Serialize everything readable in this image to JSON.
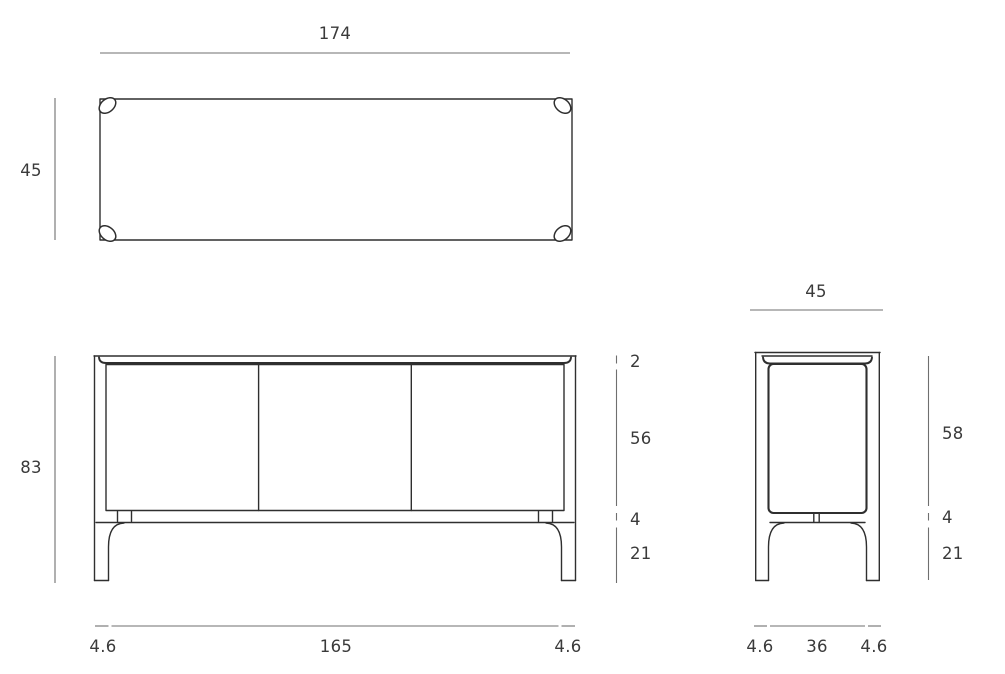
{
  "drawing": {
    "type": "furniture-dimension-diagram",
    "subject": "three-door sideboard technical drawing (top, front, side views)",
    "units_shown": false,
    "colors": {
      "line": "#2f2f2f",
      "dim_line": "#6f6f6f",
      "text": "#3a3a3a",
      "background": "#ffffff"
    },
    "views": {
      "top": {
        "width": "174",
        "depth": "45"
      },
      "front": {
        "overall_height": "83",
        "top_thickness": "2",
        "door_height": "56",
        "rail_height": "4",
        "leg_height": "21",
        "foot_left": "4.6",
        "body_width": "165",
        "foot_right": "4.6"
      },
      "side": {
        "overall_depth": "45",
        "body_height": "58",
        "rail_height": "4",
        "leg_height": "21",
        "foot_left": "4.6",
        "body_depth": "36",
        "foot_right": "4.6"
      }
    }
  }
}
